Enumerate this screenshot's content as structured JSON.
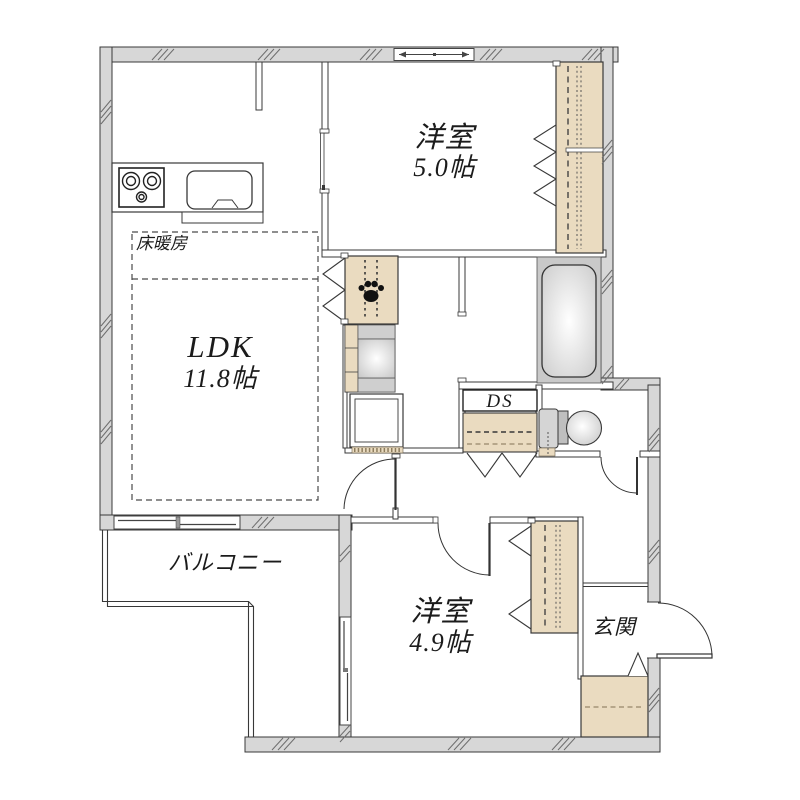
{
  "rooms": {
    "bedroom_top": {
      "name": "洋室",
      "size": "5.0帖"
    },
    "bedroom_bottom": {
      "name": "洋室",
      "size": "4.9帖"
    },
    "ldk": {
      "name": "LDK",
      "size": "11.8帖"
    },
    "balcony": {
      "name": "バルコニー"
    },
    "entrance": {
      "name": "玄関"
    },
    "duct_space": {
      "name": "DS"
    },
    "floor_heating": {
      "name": "床暖房"
    }
  },
  "icons": {
    "paw": "paw-print-icon",
    "stove": "stove-burners-icon",
    "sink": "kitchen-sink-icon",
    "bathtub": "bathtub-icon",
    "toilet": "toilet-icon"
  },
  "colors": {
    "wall_fill": "#d7d7d7",
    "closet_fill": "#eadbc0",
    "line": "#383838",
    "fixture_gray": "#c9c9c9"
  }
}
